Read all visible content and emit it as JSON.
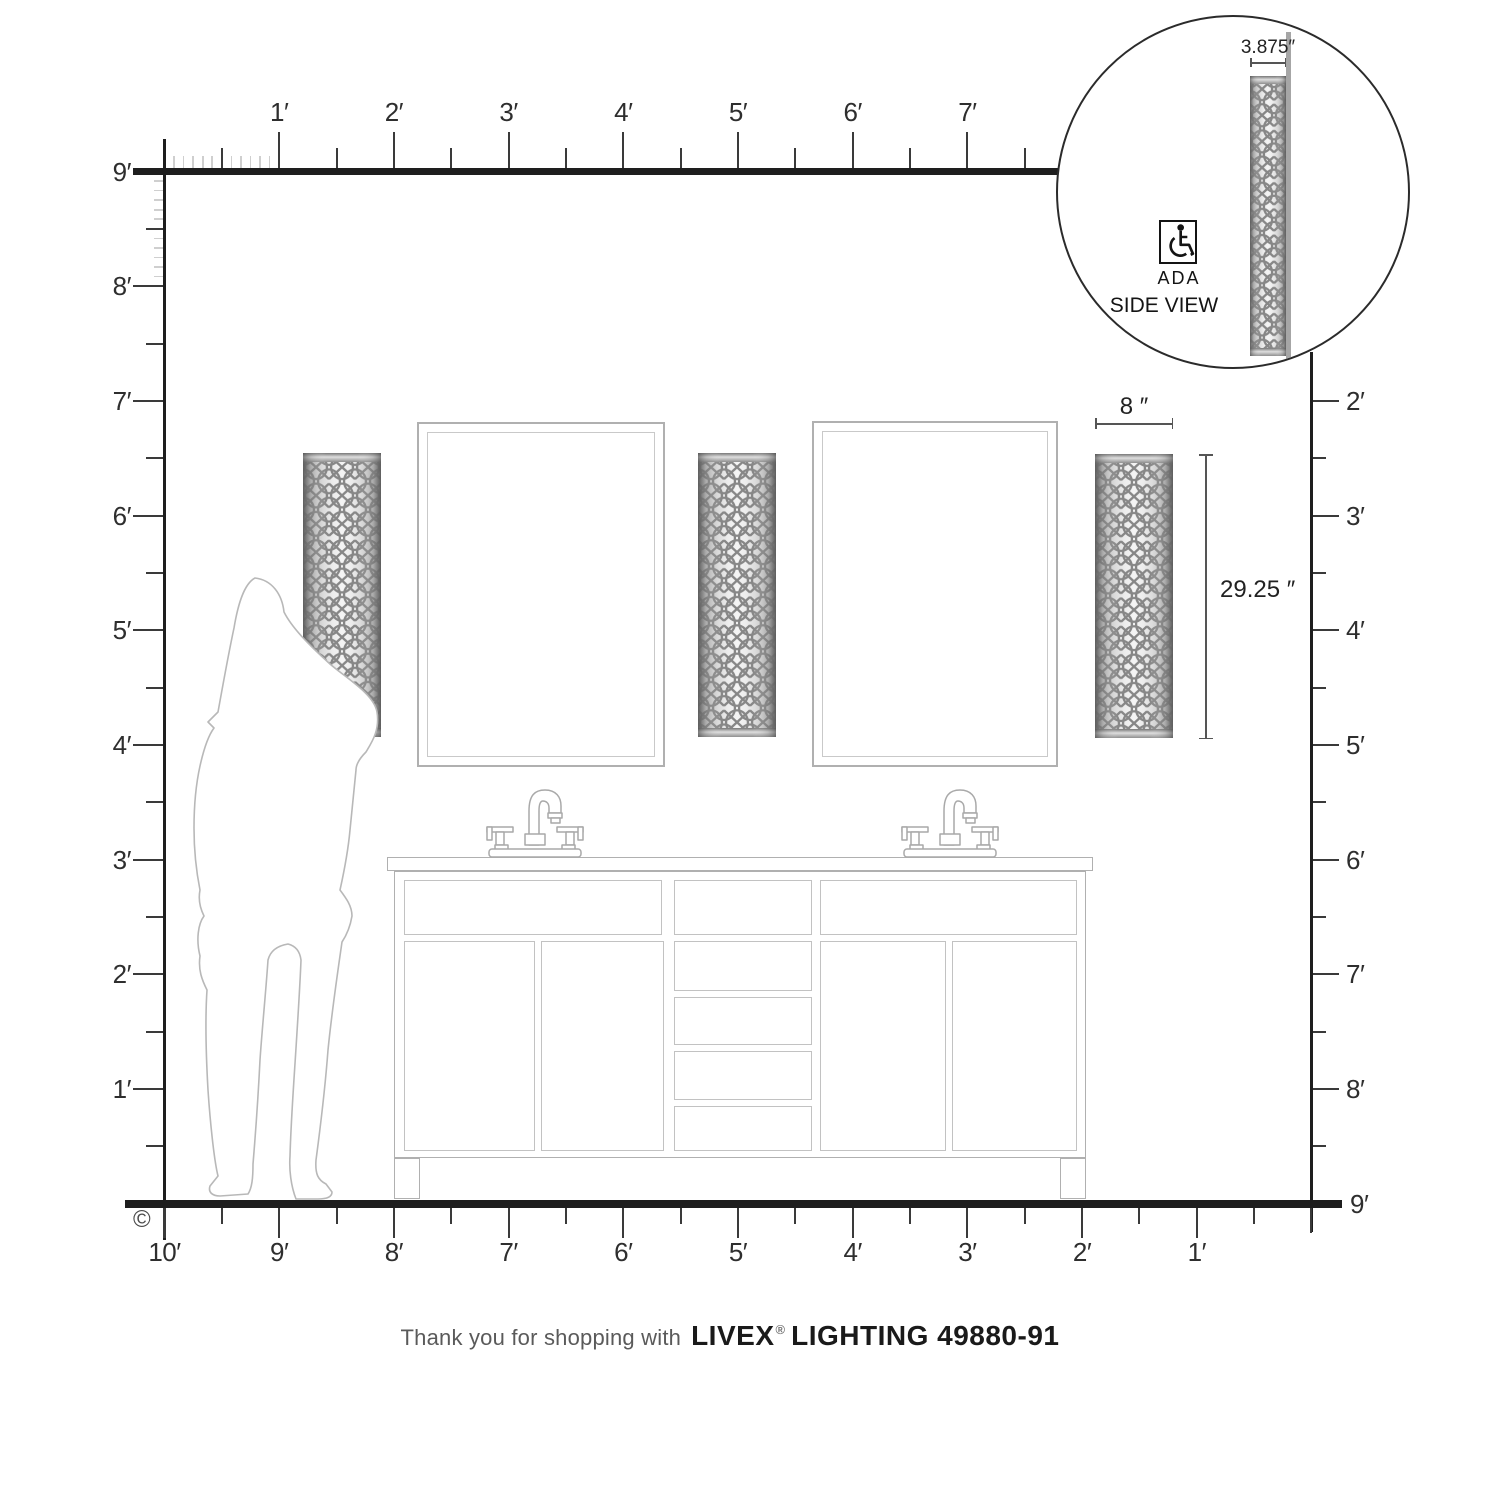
{
  "colors": {
    "ruler_line": "#1e1e1e",
    "tick_dark": "#3a3a3a",
    "tick_inch": "#cfcfcf",
    "scene_outline": "#b0b0b0",
    "panel_outline": "#c2c2c2",
    "person_outline": "#b8b8b8",
    "dimension_line": "#555555",
    "sconce_metal_edge": "#6e6e6e",
    "sconce_lattice": "#878787"
  },
  "rulers": {
    "top": {
      "labels": [
        "1′",
        "2′",
        "3′",
        "4′",
        "5′",
        "6′",
        "7′"
      ]
    },
    "left": {
      "labels": [
        "9′",
        "8′",
        "7′",
        "6′",
        "5′",
        "4′",
        "3′",
        "2′",
        "1′"
      ]
    },
    "right": {
      "labels": [
        "2′",
        "3′",
        "4′",
        "5′",
        "6′",
        "7′",
        "8′",
        "9′"
      ]
    },
    "bottom": {
      "labels": [
        "10′",
        "9′",
        "8′",
        "7′",
        "6′",
        "5′",
        "4′",
        "3′",
        "2′",
        "1′"
      ]
    }
  },
  "annotations": {
    "fixture_width": "8 ″",
    "fixture_height": "29.25 ″"
  },
  "inset": {
    "dimension_label": "3.875″",
    "ada_label": "ADA",
    "side_view_label": "SIDE VIEW"
  },
  "caption": {
    "prefix": "Thank you for shopping with",
    "brand": "LIVEX",
    "registered": "®",
    "suffix": "LIGHTING 49880-91"
  },
  "copyright": "©"
}
